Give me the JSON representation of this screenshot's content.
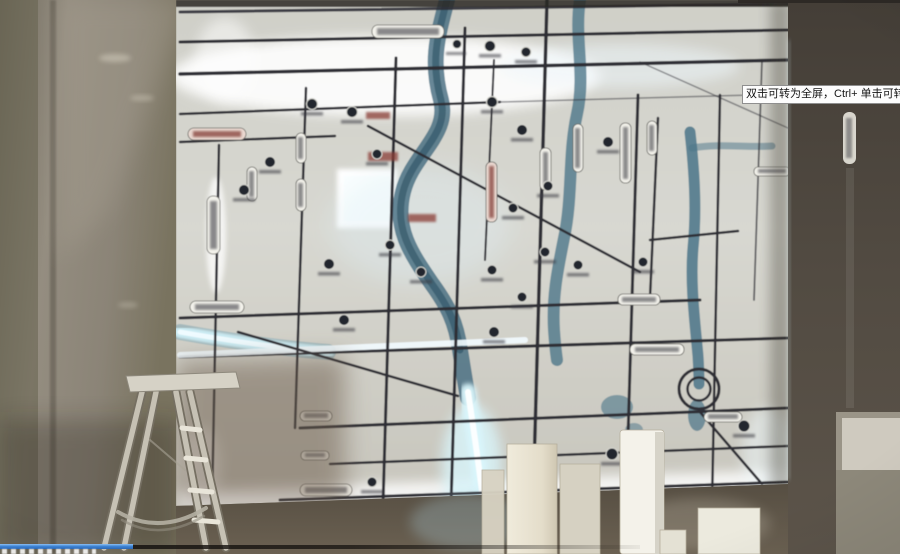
{
  "window": {
    "tooltip_text": "双击可转为全屏，Ctrl+ 单击可转为"
  },
  "player": {
    "progress_percent": 14.8,
    "progress_state": "playing-paused-frame"
  },
  "icons": {
    "poi-marker": "●",
    "road-badge": "▭",
    "ring-interchange": "◎"
  },
  "colors": {
    "accent-blue": "#3e85d6",
    "accent-blue-light": "#8ec0f2",
    "track-dark": "#16130f",
    "tooltip-bg": "#fdfdfd",
    "tooltip-border": "#8f8f8f",
    "tooltip-text": "#151515",
    "map-bg": "#d2d1c9",
    "map-glow": "#ffffff",
    "river-teal": "#45708a",
    "river-glow": "#d9f5fb",
    "road-dark": "#2e2e35",
    "badge-bg": "#f4f3ec",
    "badge-red": "#8a3c34",
    "wall-left": "#8a8478",
    "wall-right": "#46403a",
    "ladder-metal": "#c6c1b4",
    "block-cream": "#ece6d6"
  }
}
